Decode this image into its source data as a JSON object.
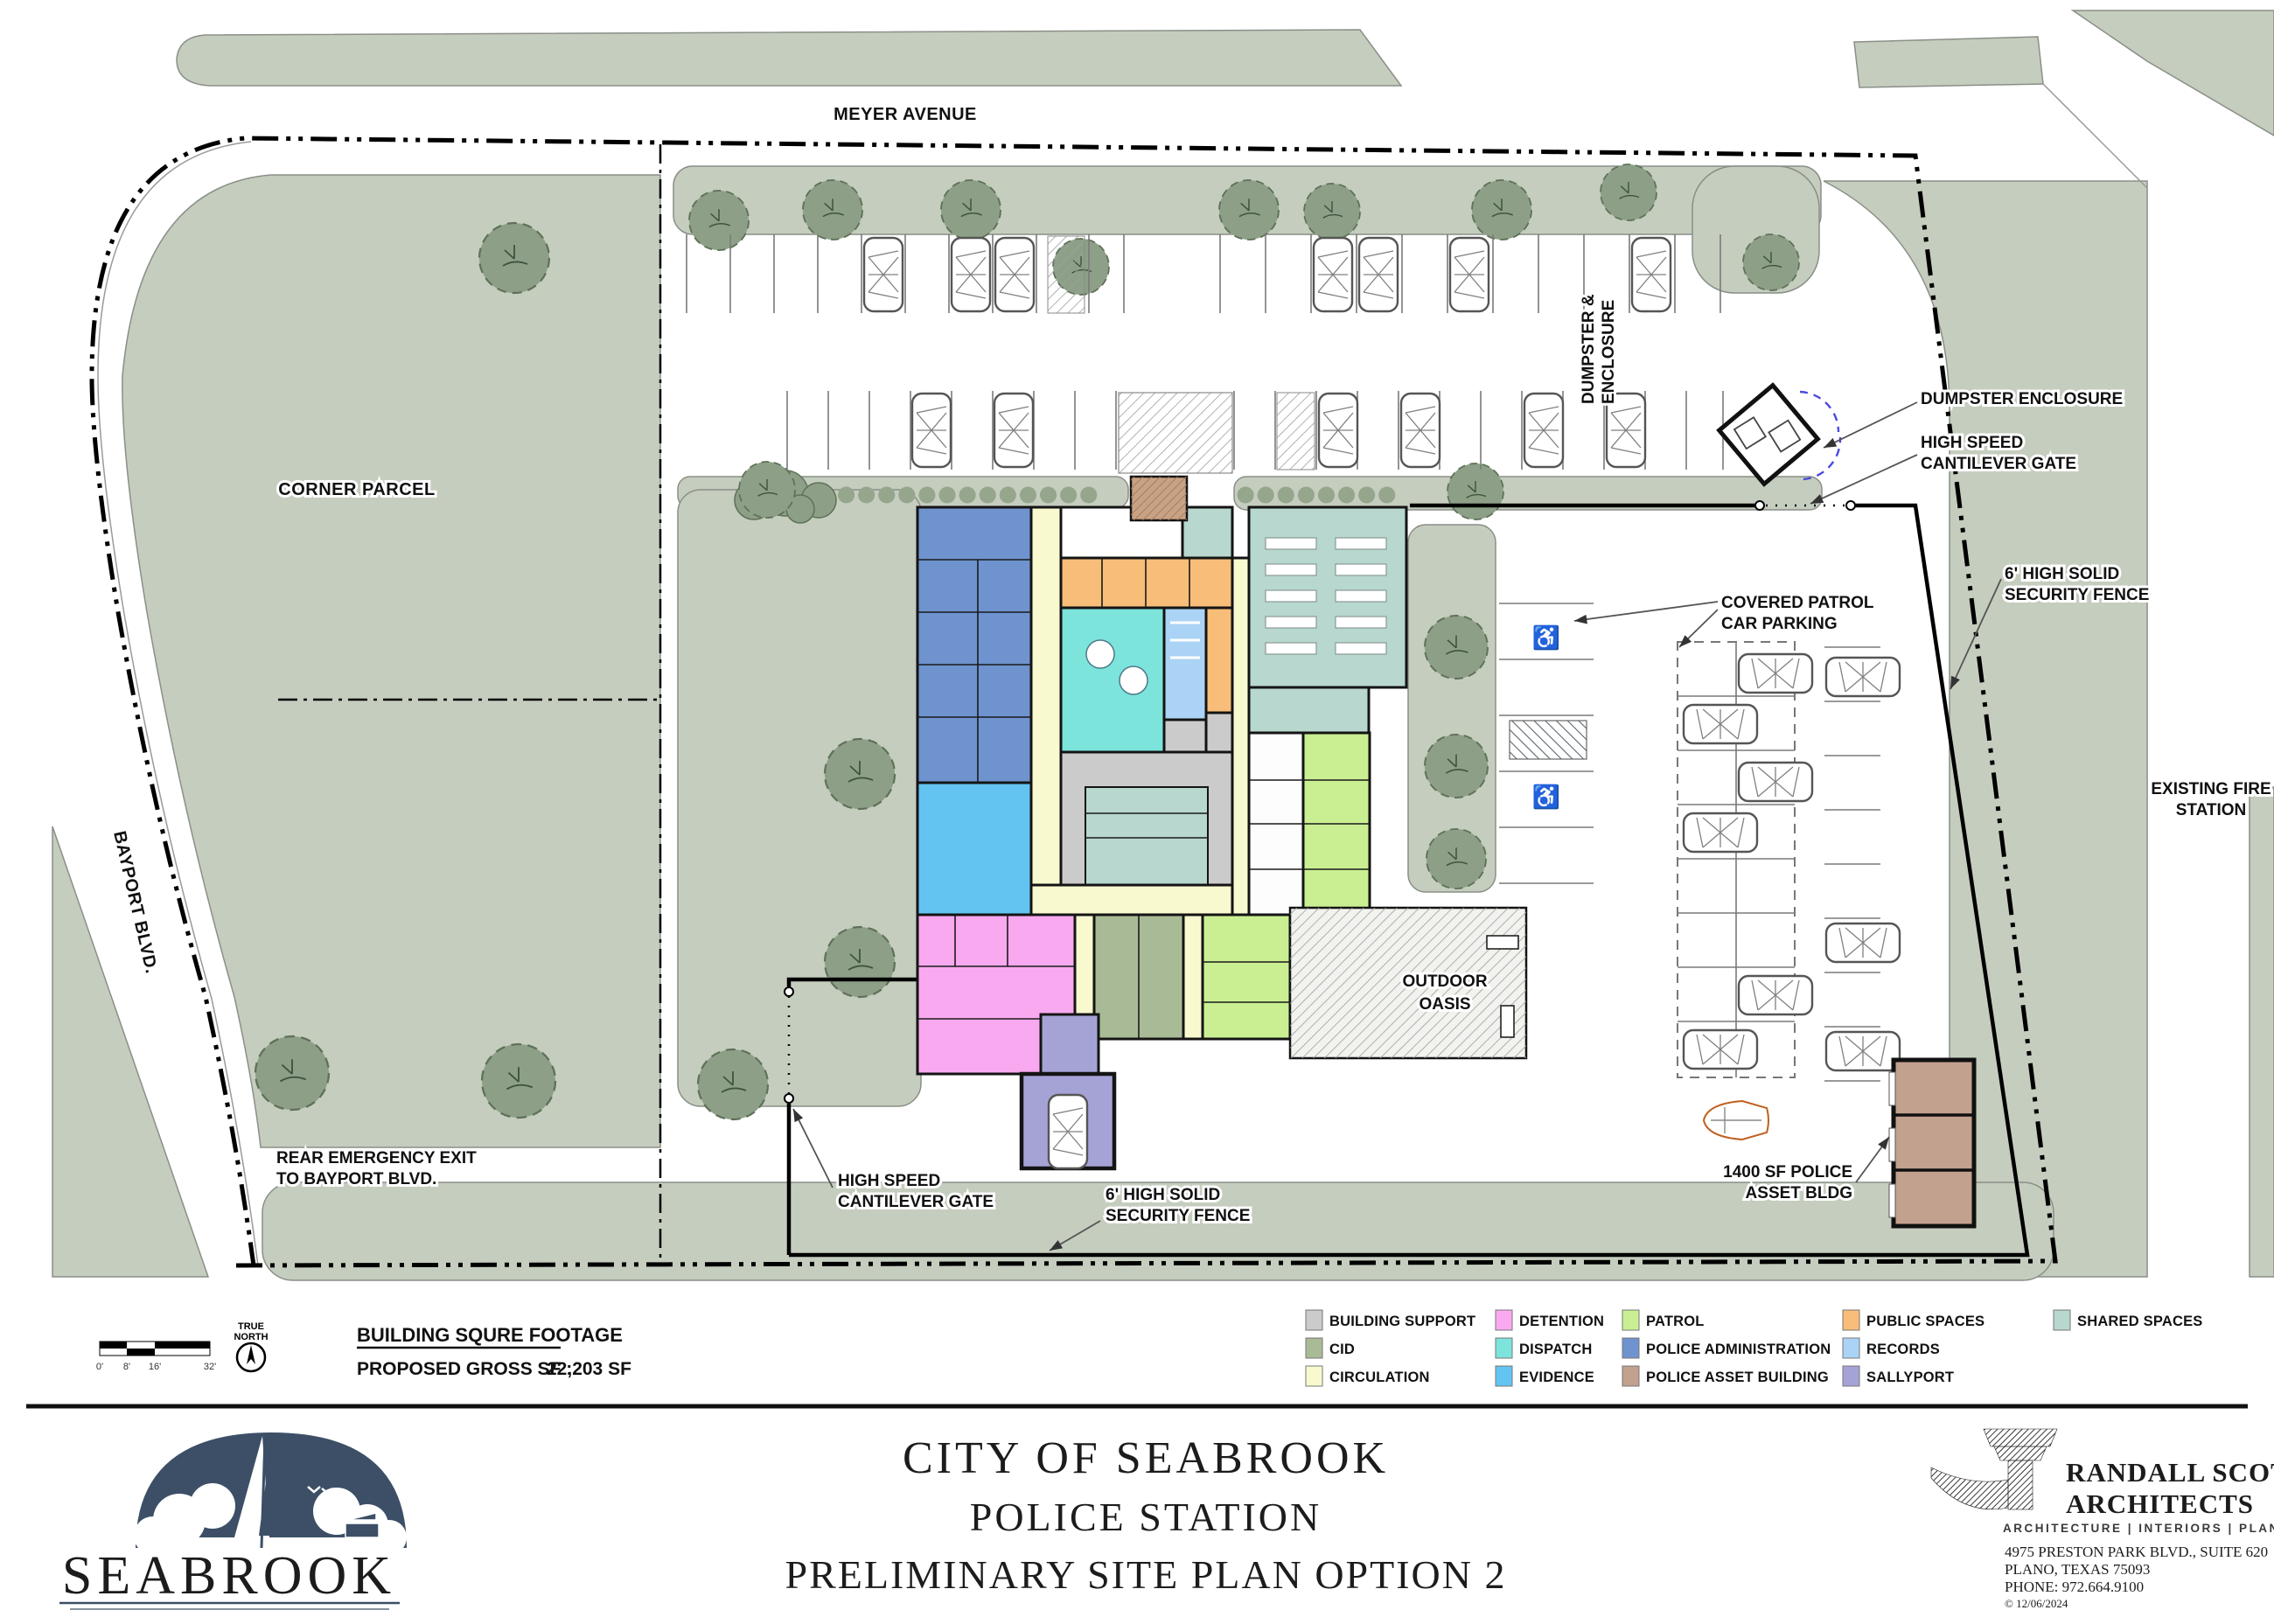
{
  "sheet_title": {
    "line1": "CITY OF SEABROOK",
    "line2": "POLICE STATION",
    "line3": "PRELIMINARY SITE PLAN OPTION 2"
  },
  "labels": {
    "meyer": "MEYER AVENUE",
    "corner_parcel": "CORNER PARCEL",
    "bayport": "BAYPORT BLVD.",
    "rear_exit": [
      "REAR EMERGENCY EXIT",
      "TO BAYPORT BLVD."
    ],
    "gate_sw": [
      "HIGH SPEED",
      "CANTILEVER GATE"
    ],
    "gate_ne": [
      "HIGH SPEED",
      "CANTILEVER GATE"
    ],
    "fence_s": [
      "6' HIGH SOLID",
      "SECURITY FENCE"
    ],
    "fence_e": [
      "6' HIGH SOLID",
      "SECURITY FENCE"
    ],
    "dumpster_callout": "DUMPSTER ENCLOSURE",
    "dumpster_vertical": [
      "DUMPSTER &",
      "ENCLOSURE"
    ],
    "fire_station": [
      "EXISTING FIRE",
      "STATION"
    ],
    "covered_parking": [
      "COVERED PATROL",
      "CAR PARKING"
    ],
    "asset_building": [
      "1400 SF POLICE",
      "ASSET BLDG"
    ],
    "outdoor_oasis": [
      "OUTDOOR",
      "OASIS"
    ]
  },
  "sqft": {
    "heading": "BUILDING SQURE FOOTAGE",
    "label": "PROPOSED GROSS SF :",
    "value": "22,203 SF"
  },
  "scale_bar": {
    "ticks": [
      "0'",
      "8'",
      "16'",
      "32'"
    ],
    "north_1": "TRUE",
    "north_2": "NORTH"
  },
  "legend": {
    "items": [
      {
        "label": "BUILDING SUPPORT",
        "color": "#cbcbcb"
      },
      {
        "label": "CID",
        "color": "#a9bb96"
      },
      {
        "label": "CIRCULATION",
        "color": "#f8f9cf"
      },
      {
        "label": "DETENTION",
        "color": "#f9a9ef"
      },
      {
        "label": "DISPATCH",
        "color": "#7ce4da"
      },
      {
        "label": "EVIDENCE",
        "color": "#63c4f2"
      },
      {
        "label": "PATROL",
        "color": "#c9ef92"
      },
      {
        "label": "POLICE ADMINISTRATION",
        "color": "#6e93cf"
      },
      {
        "label": "POLICE ASSET BUILDING",
        "color": "#c2a18f"
      },
      {
        "label": "PUBLIC SPACES",
        "color": "#f7bd79"
      },
      {
        "label": "RECORDS",
        "color": "#abd3f5"
      },
      {
        "label": "SALLYPORT",
        "color": "#a5a3d6"
      },
      {
        "label": "SHARED SPACES",
        "color": "#b7d7cf"
      }
    ]
  },
  "footer": {
    "seabrook_wordmark": "SEABROOK",
    "architect": {
      "name_1": "RANDALL SCOTT",
      "name_2": "ARCHITECTS",
      "tagline": "ARCHITECTURE | INTERIORS | PLANNING",
      "address_1": "4975 PRESTON PARK BLVD., SUITE 620",
      "address_2": "PLANO, TEXAS 75093",
      "phone": "PHONE: 972.664.9100",
      "copyright": "© 12/06/2024"
    }
  },
  "colors": {
    "building_support": "#cbcbcb",
    "cid": "#a9bb96",
    "circulation": "#f8f9cf",
    "detention": "#f9a9ef",
    "dispatch": "#7ce4da",
    "evidence": "#63c4f2",
    "patrol": "#c9ef92",
    "police_administration": "#6e93cf",
    "police_asset_building": "#c2a18f",
    "public_spaces": "#f7bd79",
    "records": "#abd3f5",
    "sallyport": "#a5a3d6",
    "shared_spaces": "#b7d7cf",
    "sage": "#c5cdbf",
    "tree": "#8da087",
    "navy": "#3c4f66",
    "brand_red": "#a01b2d"
  }
}
